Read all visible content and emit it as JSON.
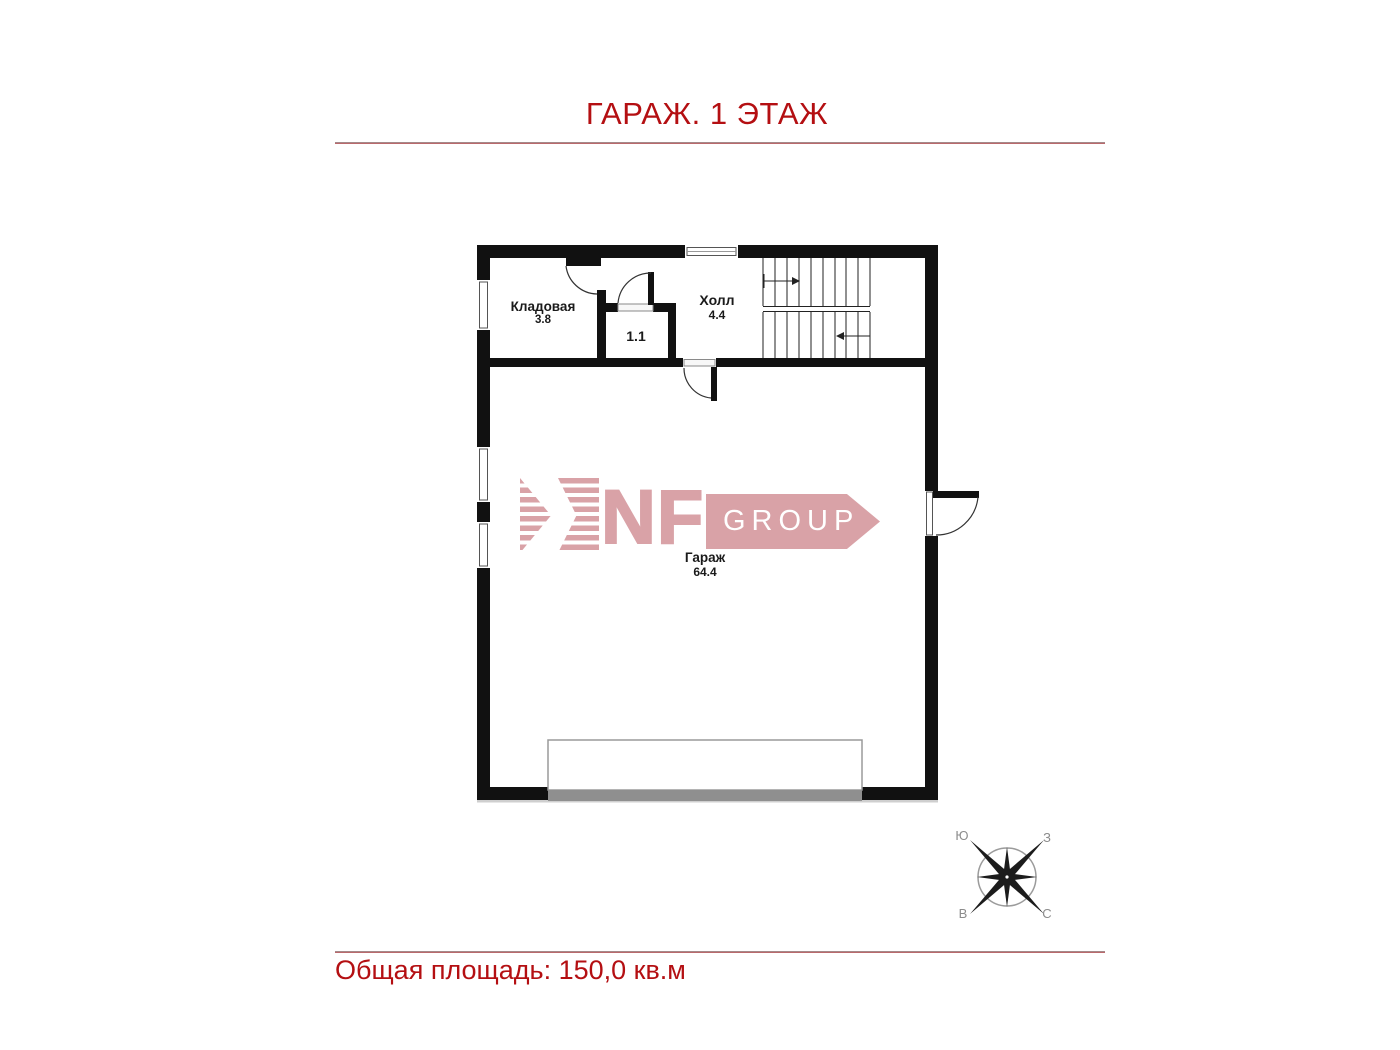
{
  "page": {
    "title": "ГАРАЖ. 1 ЭТАЖ",
    "footer_total_area": "Общая площадь: 150,0 кв.м"
  },
  "rooms": {
    "storage": {
      "name": "Кладовая",
      "area": "3.8"
    },
    "small_room": {
      "area": "1.1"
    },
    "hall": {
      "name": "Холл",
      "area": "4.4"
    },
    "garage": {
      "name": "Гараж",
      "area": "64.4"
    }
  },
  "logo": {
    "brand": "NF",
    "suffix": "GROUP"
  },
  "compass": {
    "south": "Ю",
    "west": "З",
    "east": "В",
    "north": "С"
  },
  "colors": {
    "accent_red": "#b40f12",
    "logo_pink": "#d9a2a7",
    "wall_black": "#111111",
    "gate_gray": "#8f8f8f"
  }
}
